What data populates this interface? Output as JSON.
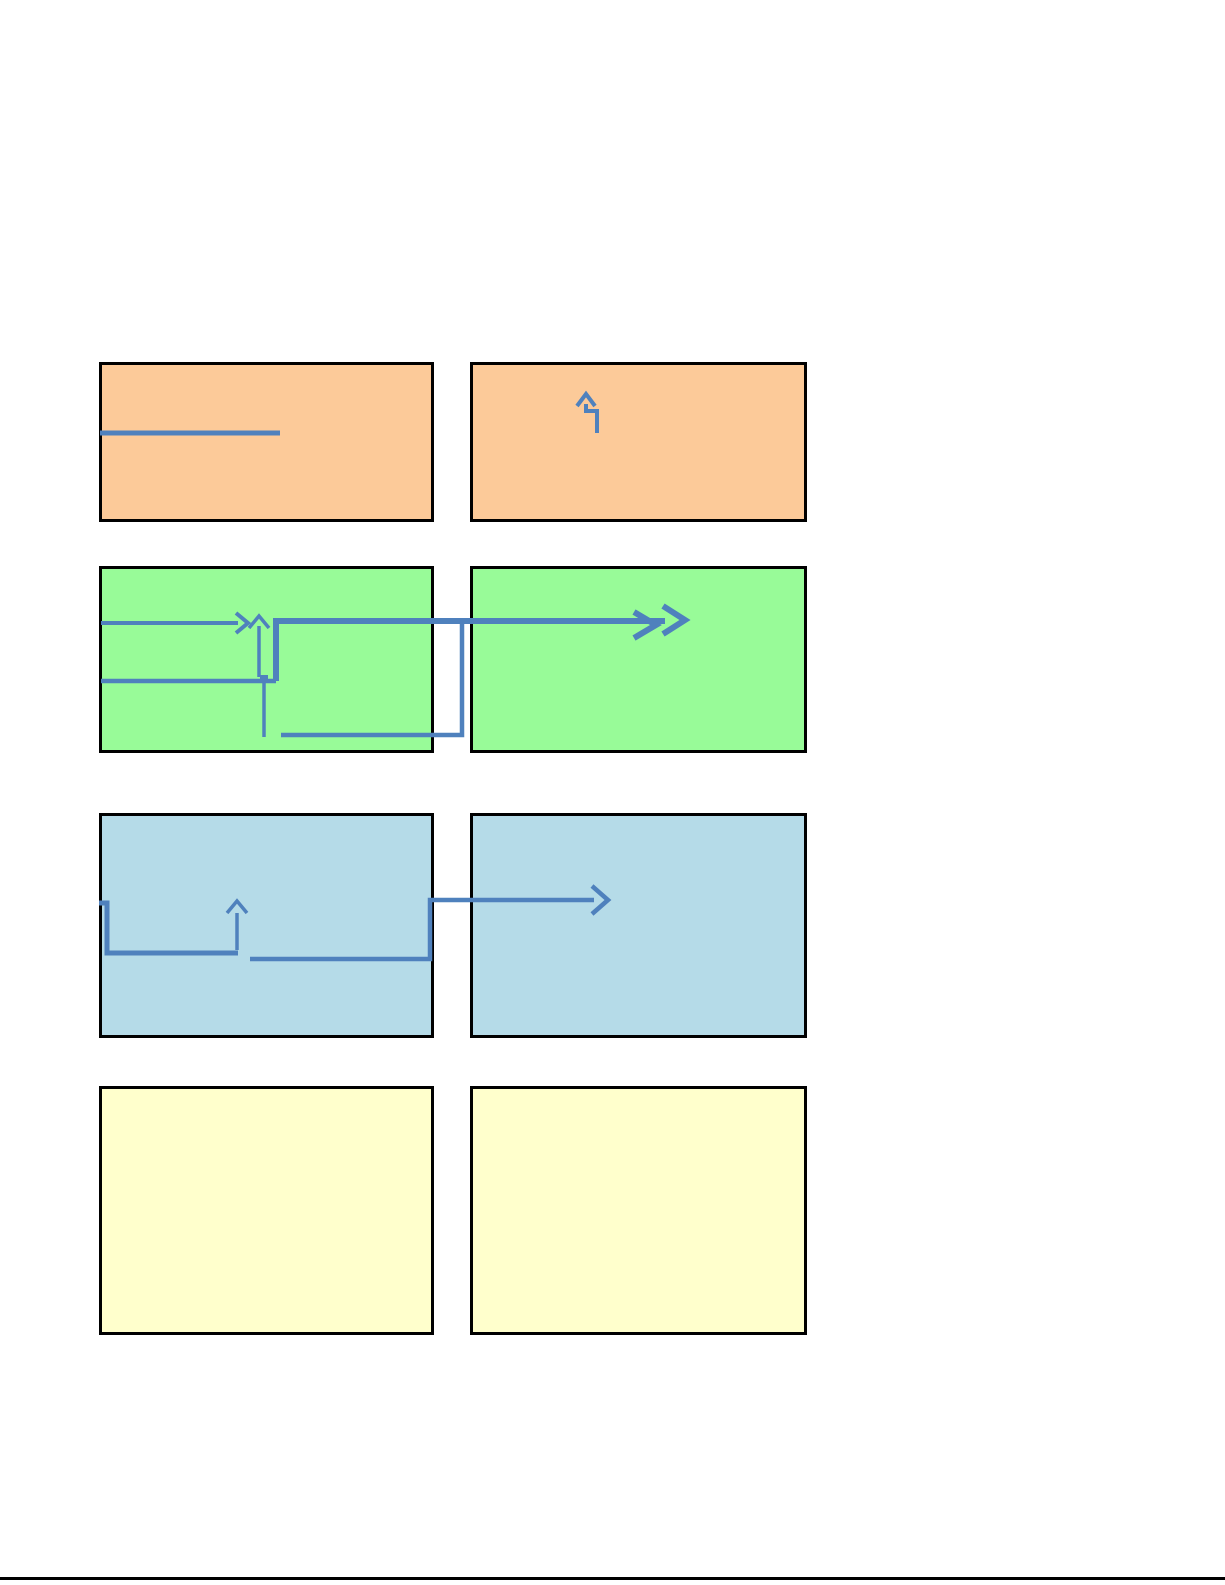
{
  "page": {
    "background": "#ffffff",
    "width": 1225,
    "height": 1585,
    "bottom_rule": {
      "color": "#000000",
      "y": 1577,
      "height": 3
    }
  },
  "diagram": {
    "connector_color": "#4F81BD",
    "box_border_color": "#000000",
    "boxes": [
      {
        "id": "orange-left",
        "fill": "#FCCA99",
        "x": 99,
        "y": 362,
        "w": 335,
        "h": 160
      },
      {
        "id": "orange-right",
        "fill": "#FCCA99",
        "x": 470,
        "y": 362,
        "w": 337,
        "h": 160
      },
      {
        "id": "green-left",
        "fill": "#98FB98",
        "x": 99,
        "y": 566,
        "w": 335,
        "h": 187
      },
      {
        "id": "green-right",
        "fill": "#98FB98",
        "x": 470,
        "y": 566,
        "w": 337,
        "h": 187
      },
      {
        "id": "blue-left",
        "fill": "#B5DBE8",
        "x": 99,
        "y": 813,
        "w": 335,
        "h": 225
      },
      {
        "id": "blue-right",
        "fill": "#B5DBE8",
        "x": 470,
        "y": 813,
        "w": 337,
        "h": 225
      },
      {
        "id": "yellow-left",
        "fill": "#FFFFCC",
        "x": 99,
        "y": 1086,
        "w": 335,
        "h": 249
      },
      {
        "id": "yellow-right",
        "fill": "#FFFFCC",
        "x": 470,
        "y": 1086,
        "w": 337,
        "h": 249
      }
    ],
    "connectors": [
      {
        "id": "orange-left-underline",
        "width": 5,
        "points": [
          [
            100,
            433
          ],
          [
            280,
            433
          ]
        ]
      },
      {
        "id": "orange-right-bent-up-arrow",
        "width": 4,
        "points": [
          [
            597,
            433
          ],
          [
            597,
            411
          ],
          [
            586,
            411
          ],
          [
            586,
            404
          ]
        ],
        "chevrons": [
          [
            [
              577,
              406
            ],
            [
              586,
              394
            ],
            [
              595,
              406
            ]
          ]
        ]
      },
      {
        "id": "green-left-arrow-right",
        "width": 4,
        "points": [
          [
            101,
            623
          ],
          [
            238,
            623
          ]
        ],
        "chevrons": [
          [
            [
              236,
              613
            ],
            [
              248,
              623
            ],
            [
              236,
              633
            ]
          ]
        ]
      },
      {
        "id": "green-left-arrow-up",
        "width": 3.5,
        "points": [
          [
            259,
            677
          ],
          [
            259,
            626
          ]
        ],
        "chevrons": [
          [
            [
              249,
              628
            ],
            [
              259,
              616
            ],
            [
              269,
              628
            ]
          ]
        ]
      },
      {
        "id": "green-left-line",
        "width": 4.5,
        "points": [
          [
            101,
            681
          ],
          [
            276,
            681
          ]
        ]
      },
      {
        "id": "green-thick-elbow-arrow",
        "width": 6,
        "points": [
          [
            276,
            681
          ],
          [
            276,
            621
          ],
          [
            665,
            621
          ]
        ],
        "chevrons": [
          [
            [
              634,
              612
            ],
            [
              656,
              625
            ],
            [
              634,
              638
            ]
          ],
          [
            [
              663,
              606
            ],
            [
              685,
              620
            ],
            [
              663,
              634
            ]
          ]
        ]
      },
      {
        "id": "green-stub-vertical",
        "width": 3.5,
        "points": [
          [
            264,
            679
          ],
          [
            264,
            737
          ]
        ],
        "dot": [
          264,
          679
        ]
      },
      {
        "id": "green-bottom-elbow",
        "width": 4.5,
        "points": [
          [
            281,
            735
          ],
          [
            462,
            735
          ],
          [
            462,
            623
          ]
        ]
      },
      {
        "id": "blue-hook-line",
        "width": 5,
        "points": [
          [
            99,
            903
          ],
          [
            107,
            903
          ],
          [
            107,
            953
          ],
          [
            238,
            953
          ]
        ]
      },
      {
        "id": "blue-arrow-up",
        "width": 3.5,
        "points": [
          [
            237,
            950
          ],
          [
            237,
            913
          ]
        ],
        "chevrons": [
          [
            [
              227,
              913
            ],
            [
              237,
              901
            ],
            [
              247,
              913
            ]
          ]
        ]
      },
      {
        "id": "blue-elbow-arrow",
        "width": 4.5,
        "points": [
          [
            250,
            959
          ],
          [
            430,
            959
          ],
          [
            430,
            900
          ],
          [
            594,
            900
          ]
        ],
        "chevrons": [
          [
            [
              592,
              886
            ],
            [
              608,
              900
            ],
            [
              592,
              914
            ]
          ]
        ]
      }
    ]
  }
}
